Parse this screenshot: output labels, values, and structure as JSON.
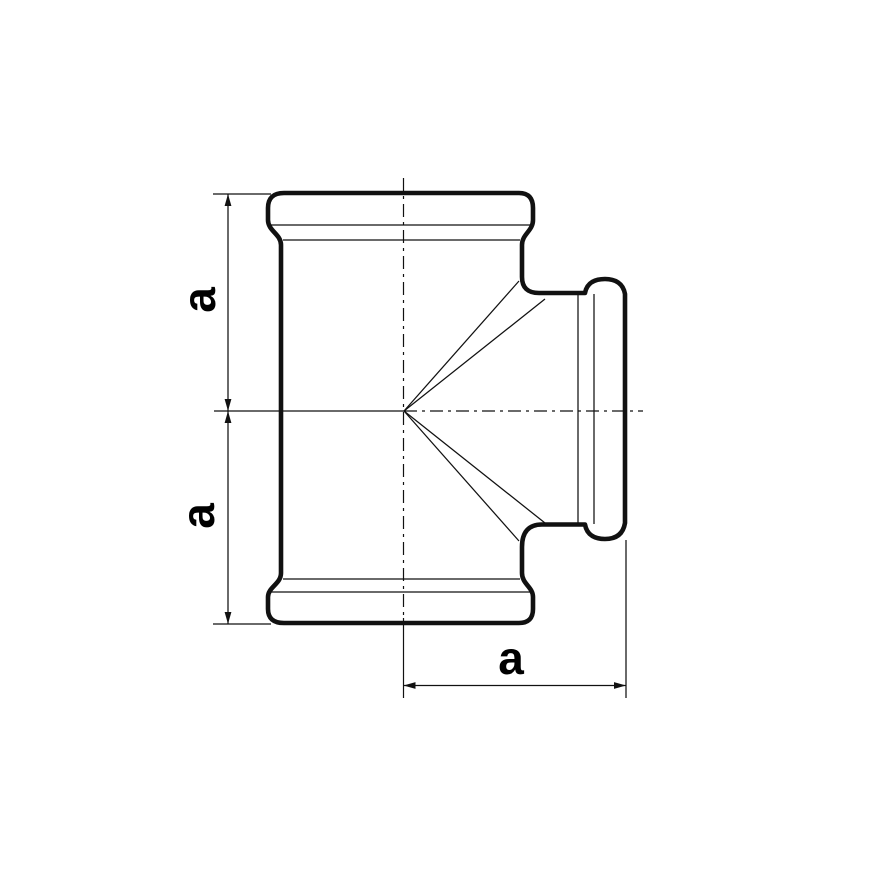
{
  "colors": {
    "ink": "#111111",
    "background": "#ffffff"
  },
  "dimensions": {
    "left_top_label": "a",
    "left_bottom_label": "a",
    "bottom_label": "a"
  }
}
